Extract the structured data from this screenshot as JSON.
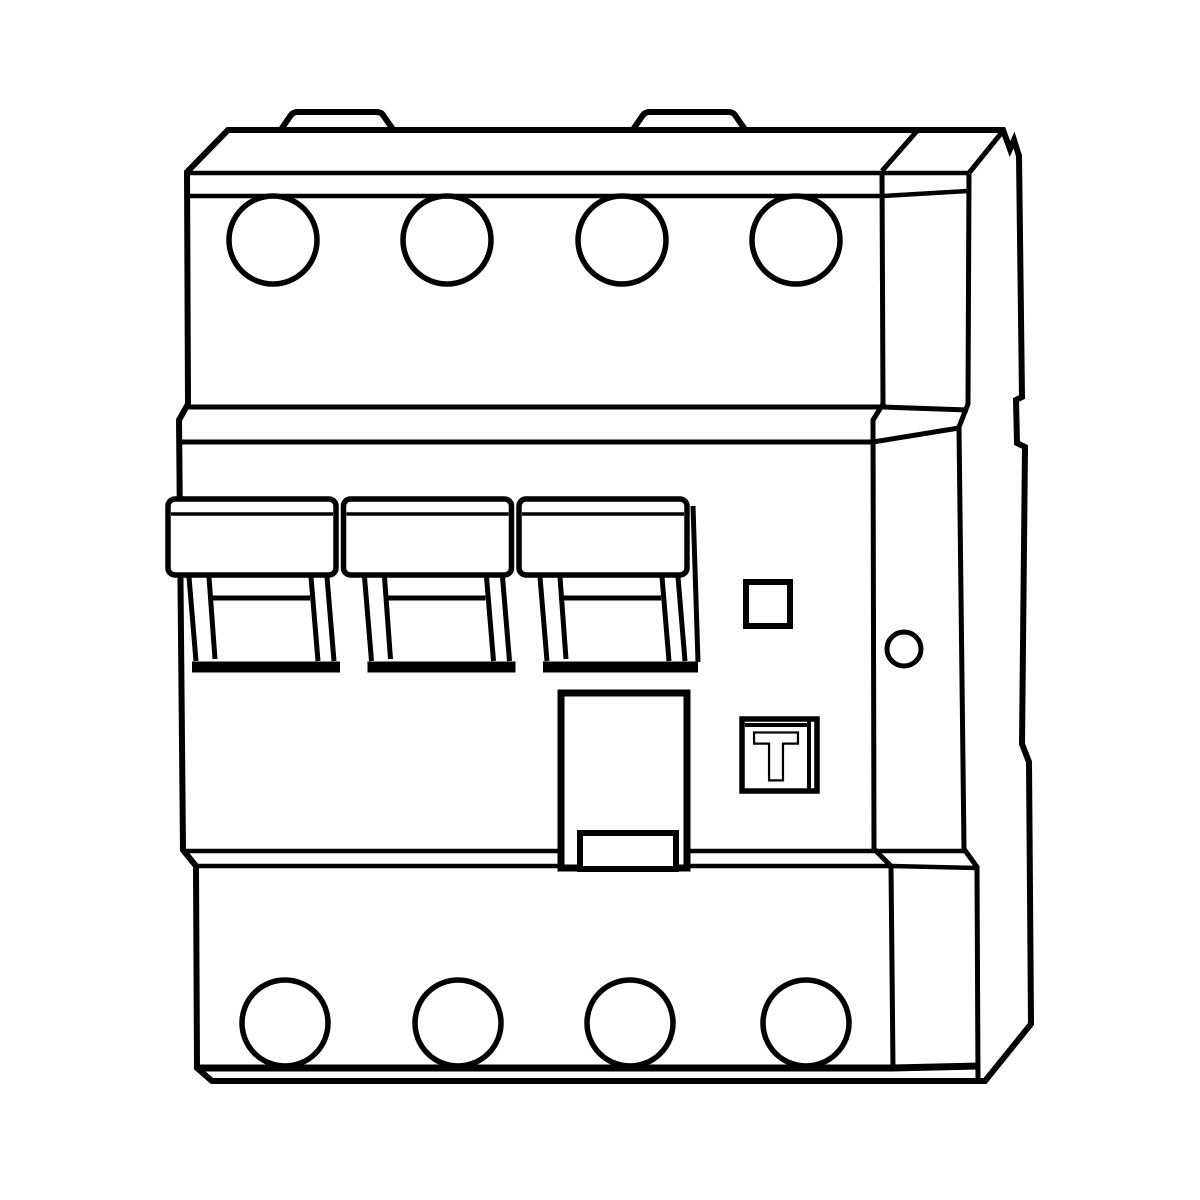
{
  "canvas": {
    "width": 1200,
    "height": 1200,
    "background": "#ffffff",
    "line_color": "#000000"
  },
  "drawing": {
    "description": "Isometric technical line drawing of a 4-pole residual current circuit breaker (RCD) with three toggle levers, eight terminal screws, label window and test button",
    "test_button_label": "T"
  },
  "top_terminals": {
    "cy": 240,
    "r": 44,
    "cx": [
      273,
      447,
      622,
      796
    ]
  },
  "bottom_terminals": {
    "cy": 1023,
    "r": 43,
    "cx": [
      285,
      458,
      630,
      806
    ]
  },
  "switches": {
    "x": [
      168,
      343.5,
      519
    ]
  },
  "mounting_tabs": {
    "x": [
      280,
      632
    ],
    "width": 114
  }
}
